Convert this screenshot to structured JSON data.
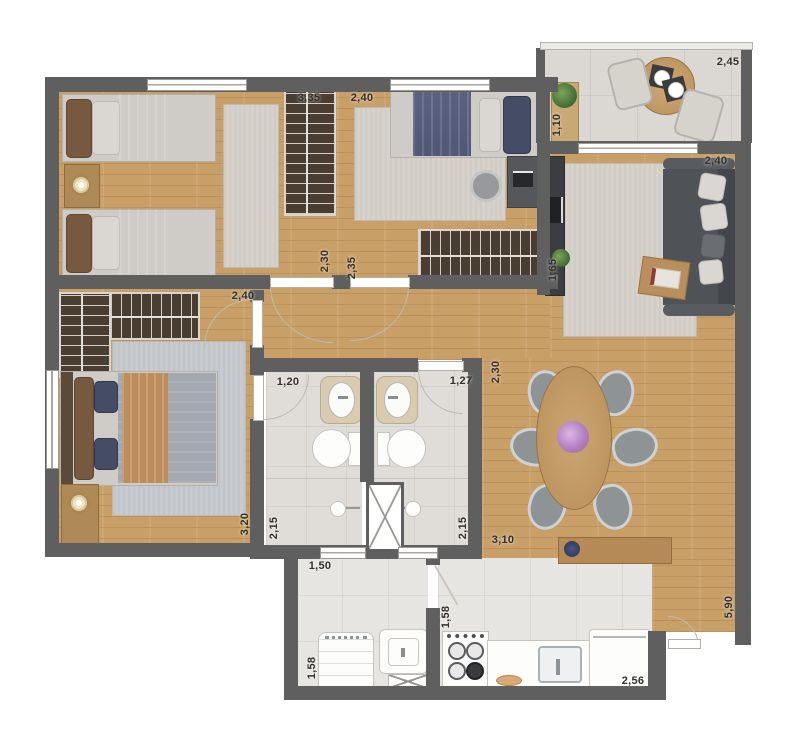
{
  "colors": {
    "wall": "#5f5f60",
    "wood": "#c99f68",
    "tile_balcony": "#dbd8d3",
    "tile_bath": "#e0ddd8",
    "tile_kitchen": "#e7e5e1",
    "closet": "#4a3e33",
    "rug": "#d6d2cb",
    "rug_blue": "#c7cacf",
    "sofa": "#4f5357",
    "table_wood": "#c2996a",
    "label": "#33302c"
  },
  "dims": [
    {
      "id": "bedroom1-wardrobe",
      "text": "3,35"
    },
    {
      "id": "bedroom2-width",
      "text": "2,40"
    },
    {
      "id": "balcony-width",
      "text": "2,45"
    },
    {
      "id": "balcony-depth",
      "text": "1,10"
    },
    {
      "id": "living-width",
      "text": "2,40"
    },
    {
      "id": "living-tv-wall",
      "text": "1,65"
    },
    {
      "id": "bedroom1-depth",
      "text": "2,30"
    },
    {
      "id": "bedroom2-depth",
      "text": "2,35"
    },
    {
      "id": "hall-width",
      "text": "2,40"
    },
    {
      "id": "bath1-width",
      "text": "1,20"
    },
    {
      "id": "bath2-width",
      "text": "1,27"
    },
    {
      "id": "dining-left-depth",
      "text": "2,30"
    },
    {
      "id": "master-depth",
      "text": "3,20"
    },
    {
      "id": "bath1-depth",
      "text": "2,15"
    },
    {
      "id": "bath2-depth",
      "text": "2,15"
    },
    {
      "id": "dining-width",
      "text": "3,10"
    },
    {
      "id": "laundry-width",
      "text": "1,50"
    },
    {
      "id": "laundry-depth",
      "text": "1,58"
    },
    {
      "id": "kitchen-passage",
      "text": "1,58"
    },
    {
      "id": "kitchen-width",
      "text": "2,56"
    },
    {
      "id": "living-length",
      "text": "5,90"
    }
  ]
}
